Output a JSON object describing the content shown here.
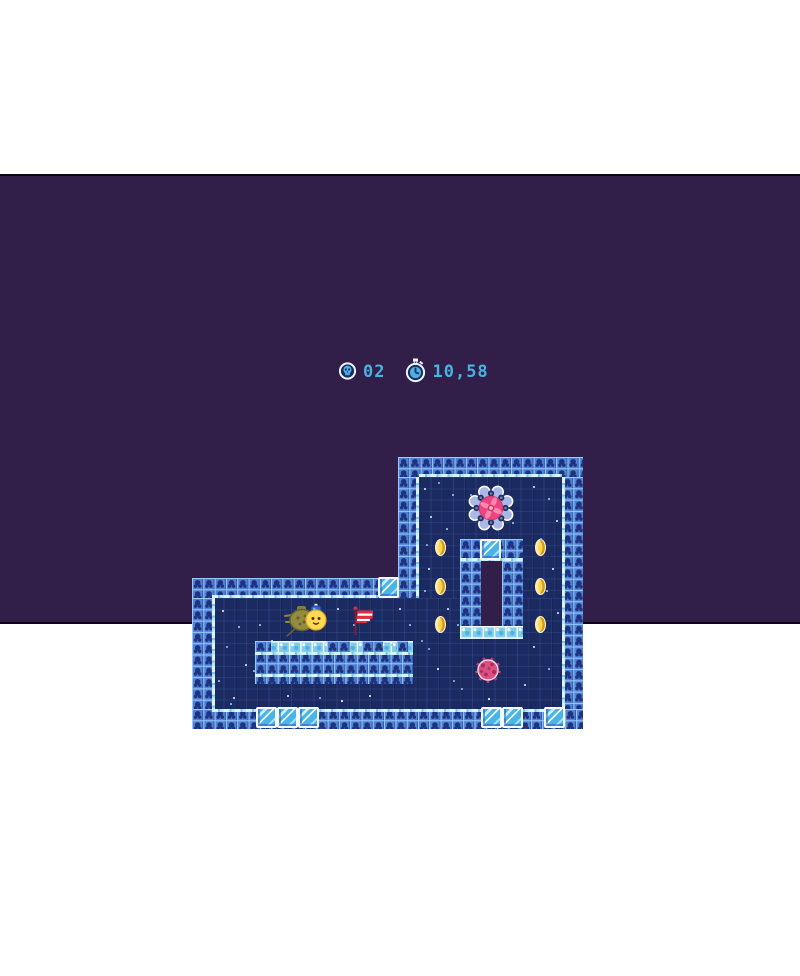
{
  "hud": {
    "skull_count": "02",
    "timer": "10,58",
    "text_color": "#4ab2e2",
    "icons": [
      "skull-badge",
      "stopwatch"
    ]
  },
  "colors": {
    "letterbox": "#ffffff",
    "outer_background": "#311f4a",
    "interior": "#1b2a61",
    "wall_blue": "#4d83d9",
    "wall_glyph": "#21327c",
    "icy_cap": "#d8f3fd",
    "ice_block": "#49b4e6",
    "coin_gold": "#ffd452",
    "pinwheel_pink": "#ee4380",
    "urchin_red": "#d94f80",
    "player_yellow": "#ffd94e",
    "afterimage_olive": "#96903f",
    "flag_red": "#e8273c"
  },
  "scene": {
    "interior_rects": [
      {
        "x": 419,
        "y": 301,
        "w": 143,
        "h": 232
      },
      {
        "x": 212,
        "y": 422,
        "w": 350,
        "h": 111
      }
    ],
    "hole": {
      "x": 481,
      "y": 385,
      "w": 21,
      "h": 65
    },
    "walls": [
      {
        "x": 398,
        "y": 281,
        "w": 185,
        "h": 20
      },
      {
        "x": 398,
        "y": 301,
        "w": 21,
        "h": 121
      },
      {
        "x": 562,
        "y": 301,
        "w": 21,
        "h": 232
      },
      {
        "x": 192,
        "y": 402,
        "w": 186,
        "h": 20
      },
      {
        "x": 192,
        "y": 422,
        "w": 20,
        "h": 111
      },
      {
        "x": 192,
        "y": 533,
        "w": 391,
        "h": 20
      },
      {
        "x": 460,
        "y": 363,
        "w": 63,
        "h": 22
      },
      {
        "x": 460,
        "y": 385,
        "w": 21,
        "h": 65
      },
      {
        "x": 502,
        "y": 385,
        "w": 21,
        "h": 65
      },
      {
        "x": 255,
        "y": 476,
        "w": 158,
        "h": 32
      }
    ],
    "icy_rows": [
      {
        "x": 460,
        "y": 450,
        "w": 63,
        "h": 13
      },
      {
        "x": 255,
        "y": 465,
        "w": 158,
        "h": 12
      }
    ],
    "platform_patches": [
      {
        "x": 255,
        "w": 16
      },
      {
        "x": 327,
        "w": 23
      },
      {
        "x": 362,
        "w": 21
      },
      {
        "x": 397,
        "w": 11
      }
    ],
    "caps_h": [
      {
        "x": 419,
        "y": 298,
        "w": 143
      },
      {
        "x": 212,
        "y": 419,
        "w": 166
      },
      {
        "x": 212,
        "y": 533,
        "w": 350
      },
      {
        "x": 460,
        "y": 382,
        "w": 63
      },
      {
        "x": 255,
        "y": 476,
        "w": 158
      },
      {
        "x": 255,
        "y": 498,
        "w": 158
      }
    ],
    "caps_v": [
      {
        "x": 562,
        "y": 301,
        "h": 232
      },
      {
        "x": 416,
        "y": 301,
        "h": 121
      },
      {
        "x": 212,
        "y": 422,
        "h": 111
      }
    ],
    "ice_blocks": [
      {
        "x": 480,
        "y": 363,
        "s": 21
      },
      {
        "x": 378,
        "y": 401,
        "s": 21
      },
      {
        "x": 256,
        "y": 531,
        "s": 21
      },
      {
        "x": 277,
        "y": 531,
        "s": 21
      },
      {
        "x": 298,
        "y": 531,
        "s": 21
      },
      {
        "x": 481,
        "y": 531,
        "s": 21
      },
      {
        "x": 502,
        "y": 531,
        "s": 21
      },
      {
        "x": 544,
        "y": 531,
        "s": 21
      }
    ],
    "coins": [
      {
        "x": 441,
        "y": 372
      },
      {
        "x": 541,
        "y": 372
      },
      {
        "x": 441,
        "y": 411
      },
      {
        "x": 541,
        "y": 411
      },
      {
        "x": 441,
        "y": 449
      },
      {
        "x": 541,
        "y": 449
      }
    ],
    "particles": [
      [
        424,
        312,
        2,
        0
      ],
      [
        438,
        306,
        2,
        1
      ],
      [
        452,
        318,
        1.5,
        1
      ],
      [
        430,
        340,
        2,
        0
      ],
      [
        446,
        352,
        1.5,
        1
      ],
      [
        426,
        368,
        2,
        1
      ],
      [
        428,
        392,
        2,
        0
      ],
      [
        424,
        414,
        1.5,
        1
      ],
      [
        447,
        432,
        2,
        0
      ],
      [
        457,
        448,
        1.5,
        1
      ],
      [
        470,
        318,
        2,
        1
      ],
      [
        512,
        346,
        1.5,
        1
      ],
      [
        533,
        310,
        2,
        0
      ],
      [
        548,
        322,
        1.5,
        1
      ],
      [
        556,
        344,
        2,
        0
      ],
      [
        540,
        362,
        1.5,
        1
      ],
      [
        552,
        392,
        2,
        0
      ],
      [
        546,
        414,
        1.5,
        1
      ],
      [
        557,
        436,
        2,
        0
      ],
      [
        533,
        470,
        2,
        0
      ],
      [
        548,
        492,
        1.5,
        1
      ],
      [
        524,
        508,
        2,
        0
      ],
      [
        461,
        512,
        2,
        1
      ],
      [
        488,
        522,
        1.5,
        0
      ],
      [
        428,
        472,
        2,
        1
      ],
      [
        437,
        492,
        1.5,
        0
      ],
      [
        453,
        504,
        2,
        1
      ],
      [
        222,
        434,
        2,
        0
      ],
      [
        238,
        450,
        1.5,
        1
      ],
      [
        226,
        470,
        2,
        1
      ],
      [
        245,
        488,
        2,
        0
      ],
      [
        218,
        504,
        1.5,
        1
      ],
      [
        233,
        521,
        2,
        0
      ],
      [
        259,
        448,
        1.5,
        1
      ],
      [
        271,
        464,
        2,
        0
      ],
      [
        253,
        494,
        1.5,
        1
      ],
      [
        287,
        519,
        2,
        0
      ],
      [
        305,
        468,
        1.5,
        1
      ],
      [
        319,
        521,
        2,
        1
      ],
      [
        337,
        432,
        2,
        0
      ],
      [
        353,
        448,
        1.5,
        1
      ],
      [
        369,
        519,
        2,
        0
      ],
      [
        391,
        468,
        1.5,
        1
      ],
      [
        399,
        432,
        2,
        0
      ],
      [
        409,
        448,
        1.5,
        1
      ],
      [
        421,
        464,
        2,
        1
      ],
      [
        341,
        524,
        1.5,
        0
      ],
      [
        230,
        527,
        1.5,
        1
      ]
    ],
    "windmill": {
      "x": 467,
      "y": 308
    },
    "urchin": {
      "x": 472,
      "y": 478
    },
    "player": {
      "x": 283,
      "y": 421
    },
    "flag": {
      "x": 348,
      "y": 428
    }
  }
}
